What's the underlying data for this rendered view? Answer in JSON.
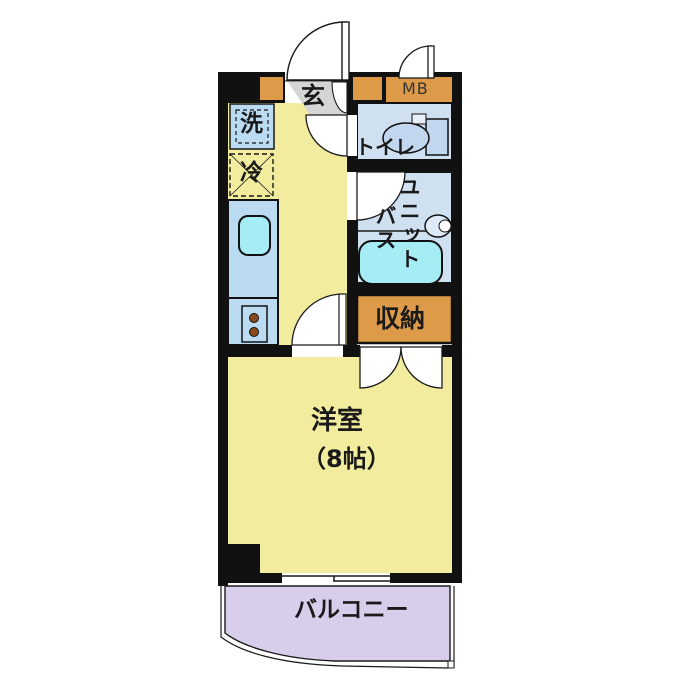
{
  "title": "apartment-floor-plan",
  "rooms": {
    "entrance": {
      "label": "玄"
    },
    "meter_box": {
      "label": "MB"
    },
    "toilet": {
      "label": "トイレ"
    },
    "unit_bath": {
      "label_column_right": "ユニット",
      "label_column_left": "バス"
    },
    "storage": {
      "label": "収納"
    },
    "western_room": {
      "label": "洋室",
      "size_label": "（8帖）"
    },
    "balcony": {
      "label": "バルコニー"
    }
  },
  "fixtures": {
    "washing_machine": {
      "label": "洗"
    },
    "refrigerator": {
      "label": "冷"
    }
  },
  "colors": {
    "wall": "#111111",
    "floor_yellow": "#f1ec9e",
    "entrance_gray": "#d5d5d5",
    "wet_room_blue": "#cfe0f1",
    "counter_blue": "#badbf2",
    "sink_cyan": "#a5ecf4",
    "accent_orange": "#dd9b49",
    "balcony_purple": "#d8cdeb",
    "burner_brown": "#8a4a1f",
    "outline": "#1a1a1a"
  }
}
